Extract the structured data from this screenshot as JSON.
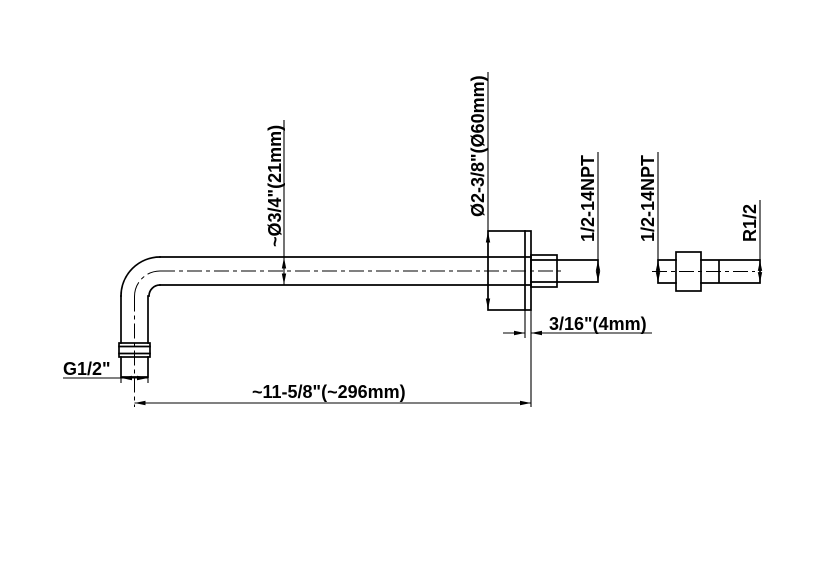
{
  "drawing": {
    "title": "shower-arm-dimension-drawing",
    "background_color": "#ffffff",
    "line_color": "#000000",
    "labels": {
      "arm_outer_diameter": "~Ø3/4\"(21mm)",
      "flange_diameter": "Ø2-3/8\"(Ø60mm)",
      "wall_thread": "1/2-14NPT",
      "flange_thickness": "3/16\"(4mm)",
      "head_thread": "G1/2\"",
      "arm_length": "~11-5/8\"(~296mm)",
      "adapter_inlet_thread": "1/2-14NPT",
      "adapter_outlet_thread": "R1/2"
    }
  }
}
